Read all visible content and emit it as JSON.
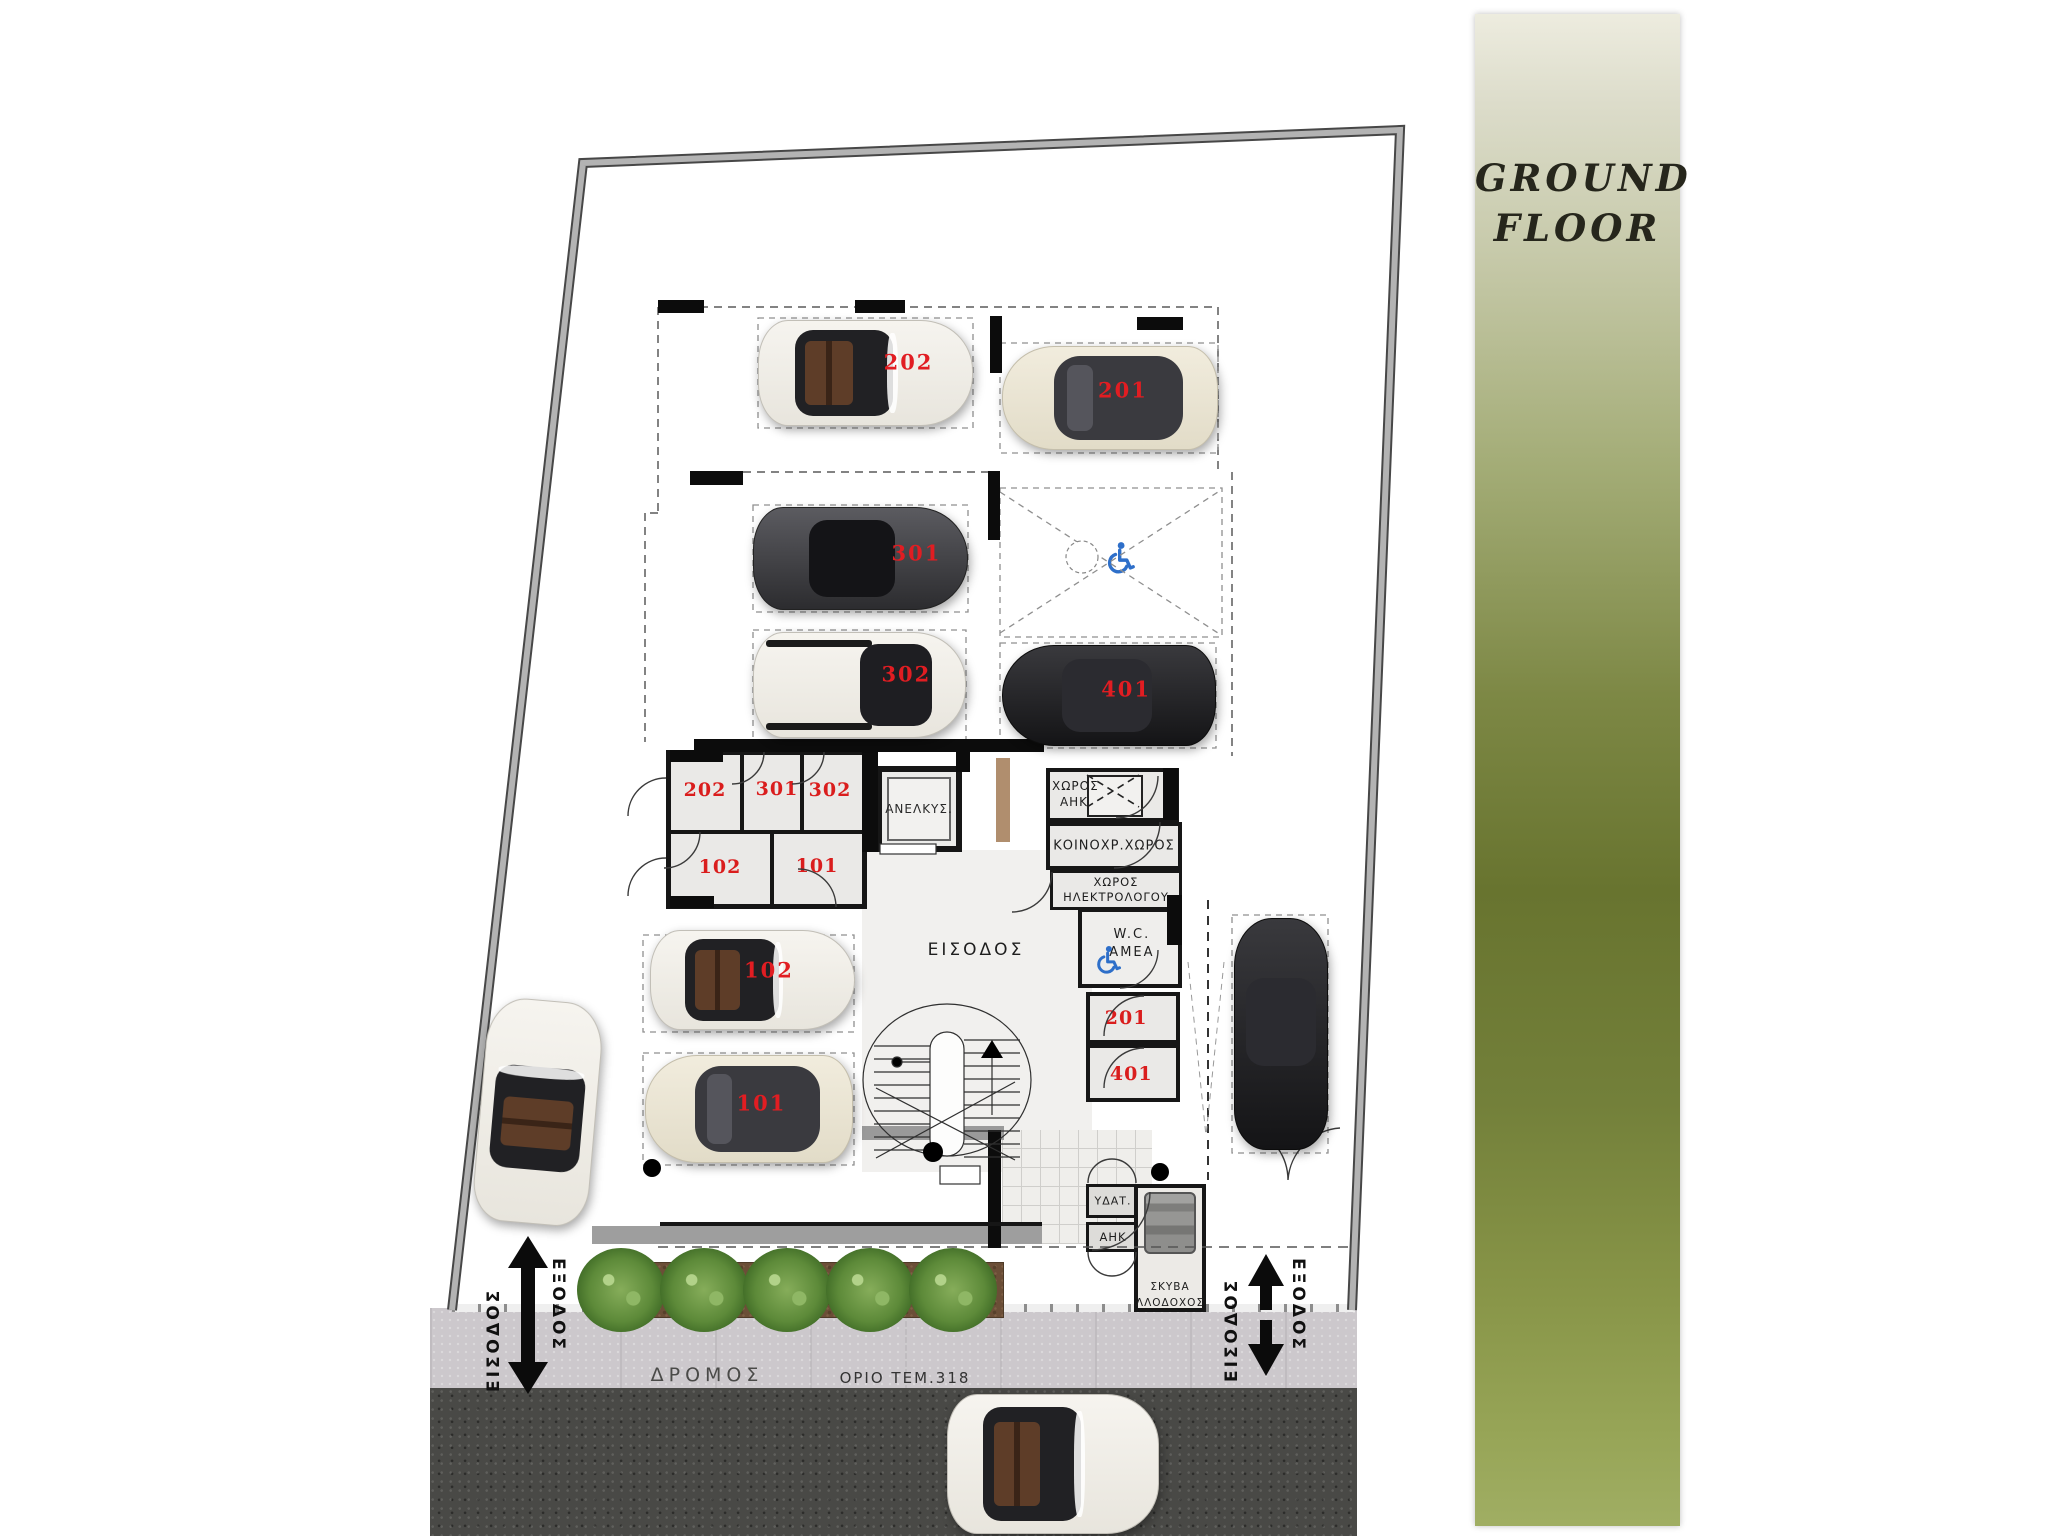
{
  "header": {
    "title_line1": "GROUND",
    "title_line2": "FLOOR"
  },
  "parking": {
    "spaces": [
      {
        "label": "202"
      },
      {
        "label": "201"
      },
      {
        "label": "301"
      },
      {
        "label": "302"
      },
      {
        "label": "401"
      },
      {
        "label": "102"
      },
      {
        "label": "101"
      }
    ],
    "accessible_space": {
      "label": "P8"
    }
  },
  "rooms": {
    "storage": [
      {
        "label": "202"
      },
      {
        "label": "301"
      },
      {
        "label": "302"
      },
      {
        "label": "102"
      },
      {
        "label": "101"
      }
    ],
    "elevator": {
      "label": "ΑΝΕΛΚΥΣ."
    },
    "entrance_hall": {
      "label": "ΕΙΣΟΔΟΣ"
    },
    "ahk_room": {
      "line1": "ΧΩΡΟΣ",
      "line2": "ΑΗΚ"
    },
    "communal": {
      "label": "ΚΟΙΝΟΧΡ.ΧΩΡΟΣ"
    },
    "electrician": {
      "line1": "ΧΩΡΟΣ",
      "line2": "ΗΛΕΚΤΡΟΛΟΓΟΥ"
    },
    "wc": {
      "line1": "W.C.",
      "line2": "AMEA"
    },
    "store_201": {
      "label": "201"
    },
    "store_401": {
      "label": "401"
    },
    "water": {
      "label": "ΥΔΑΤ."
    },
    "ahk_meter": {
      "label": "ΑΗΚ"
    },
    "garbage": {
      "line1": "ΣΚΥΒΑ",
      "line2": "ΛΛΟΔΟΧΟΣ"
    }
  },
  "site": {
    "road_label": "ΔΡΟΜΟΣ",
    "boundary_label": "ΟΡΙΟ ΤΕΜ.318",
    "left_gate": {
      "entry": "ΕΙΣΟΔΟΣ",
      "exit": "ΕΞΟΔΟΣ"
    },
    "right_gate": {
      "entry": "ΕΙΣΟΔΟΣ",
      "exit": "ΕΞΟΔΟΣ"
    }
  },
  "colors": {
    "accent_red": "#e11d22",
    "wheelchair_blue": "#2e6fc9",
    "olive": "#6e7936"
  }
}
